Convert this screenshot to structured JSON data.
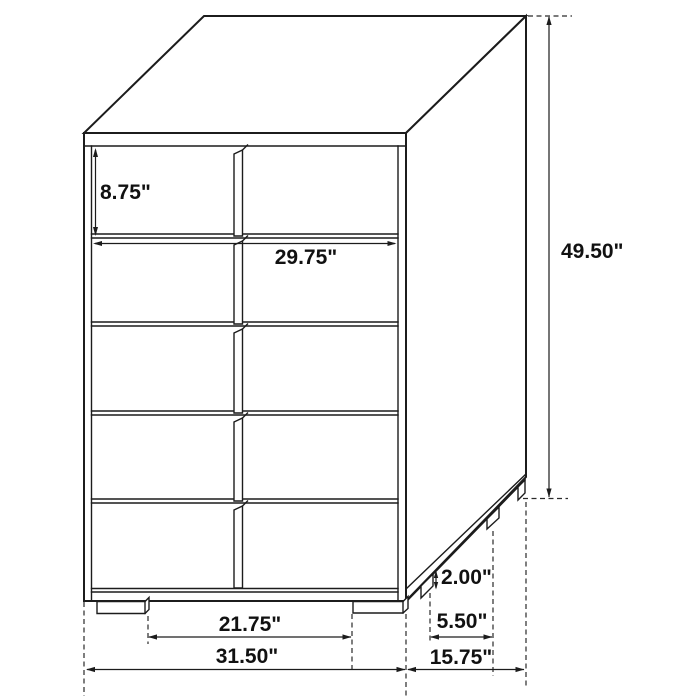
{
  "drawing": {
    "name": "five-drawer-chest-dimension-diagram",
    "units": "inches",
    "colors": {
      "background": "#ffffff",
      "line": "#1c1c1c",
      "text": "#111111"
    },
    "dim": {
      "drawer_height": "8.75\"",
      "drawer_width": "29.75\"",
      "overall_height": "49.50\"",
      "foot_height": "2.00\"",
      "side_foot_spacing": "5.50\"",
      "overall_depth": "15.75\"",
      "front_foot_spacing": "21.75\"",
      "overall_width": "31.50\""
    }
  }
}
